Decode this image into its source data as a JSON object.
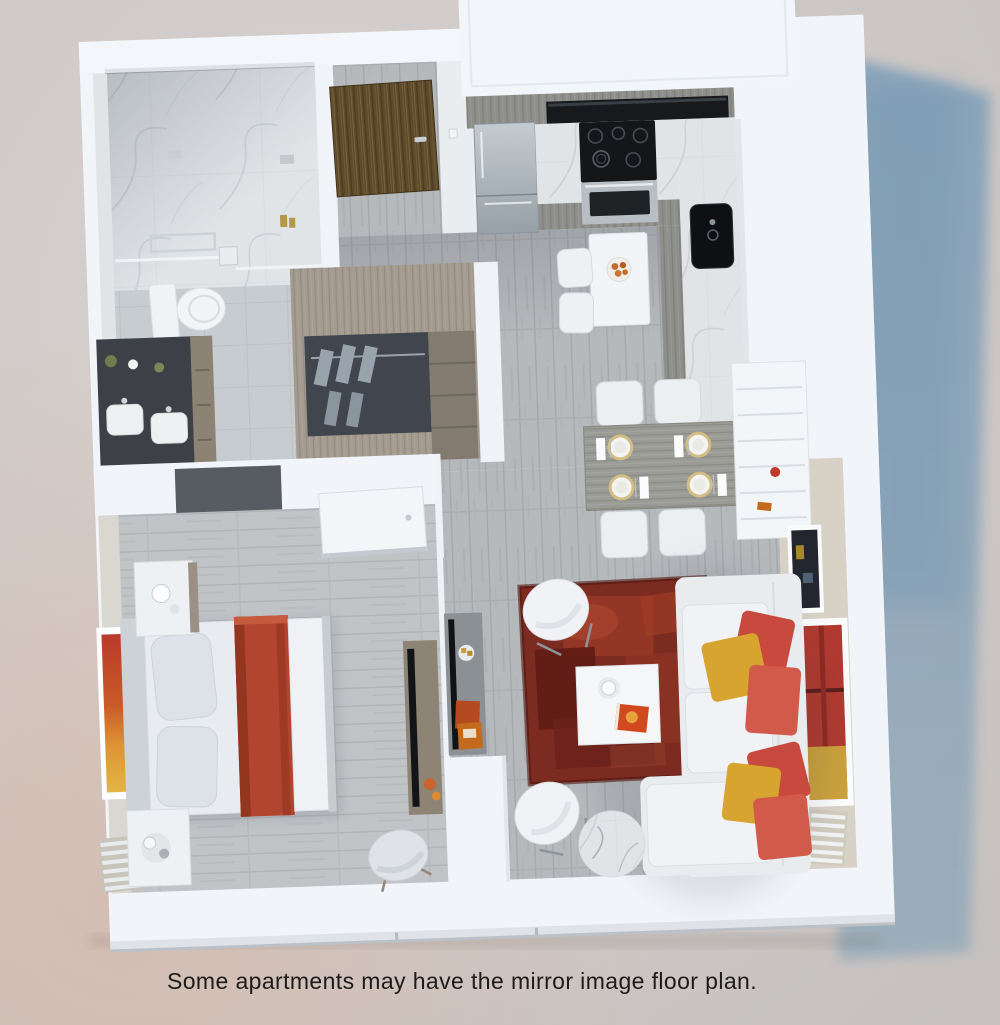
{
  "caption": {
    "text": "Some apartments may have the mirror image floor plan."
  },
  "scene": {
    "type": "3d-floor-plan-render",
    "rooms": [
      "bathroom",
      "walk-in-closet",
      "entry",
      "kitchen",
      "dining-area",
      "living-room",
      "bedroom"
    ]
  },
  "palette": {
    "background_beige": "#d3cdca",
    "background_pink": "#d9c2b4",
    "cast_shadow_blue": "#84a3ba",
    "wall_white": "#f1f4f8",
    "accent_wall_beige": "#d8d1c5",
    "floor_gray_wood": "#b6b9bc",
    "bedroom_floor": "#c1c4c7",
    "marble": "#e1e4e7",
    "bath_tile": "#c7ccd0",
    "vanity_dark": "#3d4147",
    "closet_wood": "#a39b8f",
    "entry_door_wood": "#5e4b2c",
    "cabinet_wood_gray": "#8e8e8a",
    "appliance_steel": "#aab3ba",
    "stove_black": "#17191c",
    "rug_red": "#7c2b21",
    "blanket_red": "#b2452f",
    "pillow_red": "#cd5146",
    "pillow_yellow": "#d7a52f",
    "sofa_white": "#edeff2",
    "art_red": "#b03a30",
    "art_yellow": "#caa13c"
  }
}
